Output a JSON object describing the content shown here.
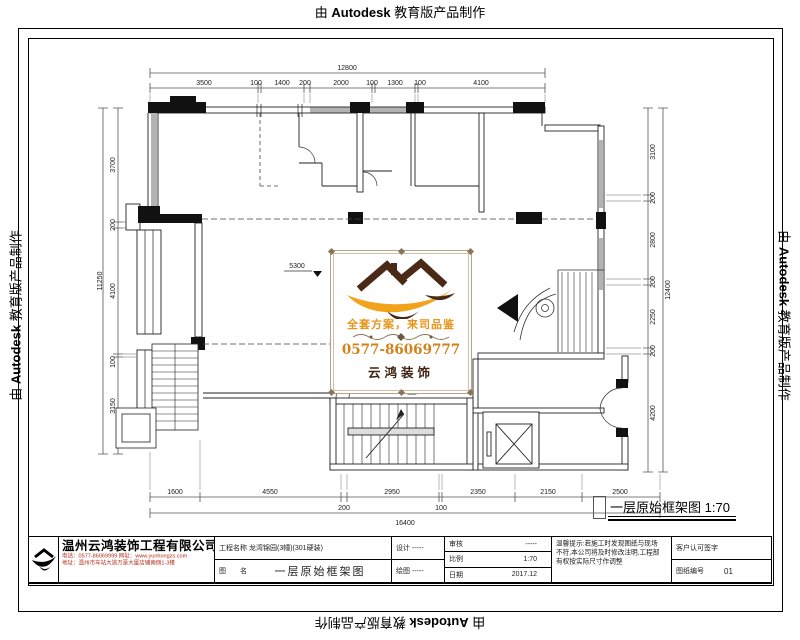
{
  "watermark": {
    "prefix": "由",
    "brand": "Autodesk",
    "suffix": "教育版产品制作"
  },
  "plan": {
    "elevation_text": "5300"
  },
  "drawing_label": {
    "title": "一层原始框架图",
    "scale": "1:70"
  },
  "logo_card": {
    "slogan": "全套方案，来司品鉴",
    "phone": "0577-86069777",
    "brand": "云鸿装饰"
  },
  "dimensions": {
    "top": {
      "overall": "12800",
      "segments": [
        "3500",
        "100",
        "1400",
        "200",
        "2000",
        "100",
        "1300",
        "100",
        "4100"
      ]
    },
    "bottom": {
      "overall": "16400",
      "segments_row1": [
        "1600",
        "4550",
        "2950",
        "2350",
        "2150",
        "2500"
      ],
      "segments_row2": [
        "200",
        "100"
      ]
    },
    "left": {
      "overall": "11250",
      "segments": [
        "3700",
        "200",
        "4100",
        "100",
        "3150"
      ]
    },
    "right": {
      "overall": "12400",
      "segments": [
        "3100",
        "200",
        "2800",
        "200",
        "2250",
        "200",
        "4200"
      ]
    }
  },
  "title_block": {
    "company": {
      "name": "温州云鸿装饰工程有限公司",
      "contact1": "电话：0577-86069999  网址：www.yunhongzs.com",
      "contact2": "地址：温州市车站大道万豪大厦店铺南侧1-3楼"
    },
    "project_label": "工程名称",
    "project_value": "龙湾锦园(3幢)(301硬装)",
    "name_label": "图　　名",
    "name_value": "一层原始框架图",
    "design_label": "设计",
    "design_value": "-----",
    "draft_label": "绘图",
    "draft_value": "-----",
    "audit_label": "审核",
    "audit_value": "-----",
    "scale_label": "比例",
    "scale_value": "1:70",
    "date_label": "日期",
    "date_value": "2017.12",
    "notice_line1": "温馨提示:若施工时发现图纸与现场",
    "notice_line2": "不符,本公司将及时修改注明,工程部",
    "notice_line3": "有权按实际尺寸作调整",
    "sign_label": "客户认可签字",
    "number_label": "图纸编号",
    "number_value": "01"
  }
}
